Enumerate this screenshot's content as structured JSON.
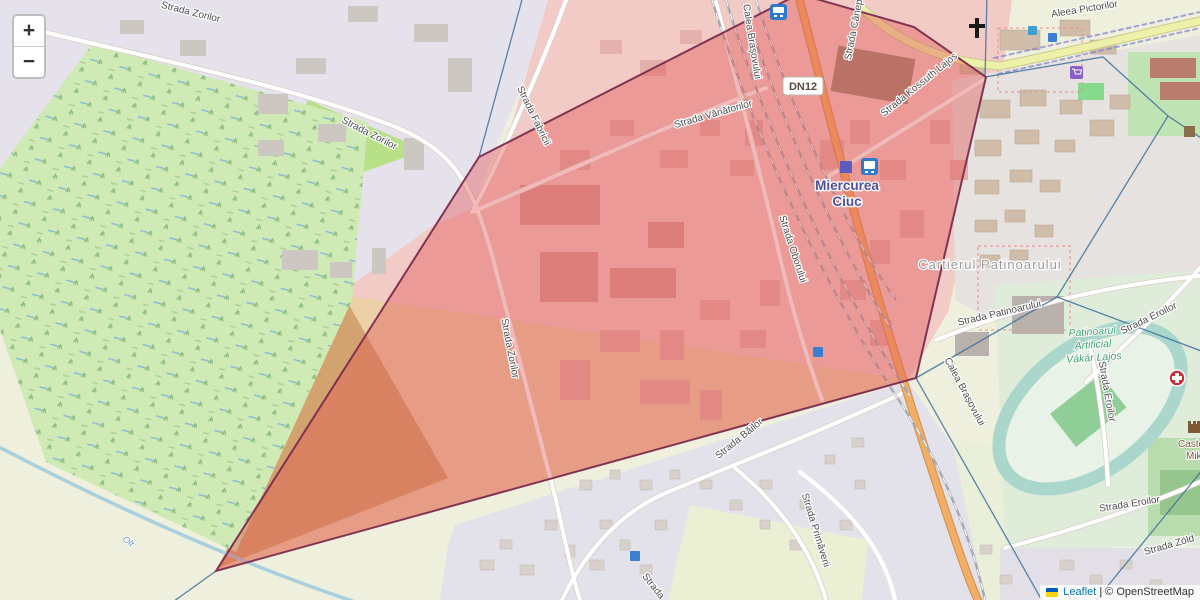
{
  "controls": {
    "zoom_in": "+",
    "zoom_out": "−"
  },
  "attribution": {
    "leaflet_link": "Leaflet",
    "separator": "|",
    "osm_credit": "© OpenStreetMap"
  },
  "badges": {
    "road_ref": "DN12"
  },
  "labels": {
    "city_line1": "Miercurea",
    "city_line2": "Ciuc",
    "neighborhood": "Cartierul Patinoarului",
    "stadium_line1": "Patinoarul",
    "stadium_line2": "Artificial",
    "stadium_line3": "Vákár Lajos",
    "castle_line1": "Castelul",
    "castle_line2": "Mikó",
    "river": "Olt",
    "streets": [
      {
        "text": "Strada Zorilor",
        "x": 190,
        "y": 15,
        "r": 14
      },
      {
        "text": "Strada Zorilor",
        "x": 368,
        "y": 136,
        "r": 27
      },
      {
        "text": "Strada Fabricii",
        "x": 531,
        "y": 117,
        "r": 64
      },
      {
        "text": "Strada Zorilor",
        "x": 507,
        "y": 349,
        "r": 79
      },
      {
        "text": "Strada Vânătorilor",
        "x": 714,
        "y": 117,
        "r": -16
      },
      {
        "text": "Strada Oborului",
        "x": 790,
        "y": 250,
        "r": 72
      },
      {
        "text": "Strada Cânepii",
        "x": 857,
        "y": 28,
        "r": -79
      },
      {
        "text": "Strada Kossuth Lajos",
        "x": 921,
        "y": 87,
        "r": -39
      },
      {
        "text": "Strada Patinoarului",
        "x": 1000,
        "y": 316,
        "r": -13
      },
      {
        "text": "Strada Eroilor",
        "x": 1150,
        "y": 321,
        "r": -26
      },
      {
        "text": "Strada Eroilor",
        "x": 1104,
        "y": 392,
        "r": 80
      },
      {
        "text": "Strada Eroilor",
        "x": 1130,
        "y": 507,
        "r": -9
      },
      {
        "text": "Strada Zöld",
        "x": 1170,
        "y": 548,
        "r": -16
      },
      {
        "text": "Calea Brașovului",
        "x": 962,
        "y": 393,
        "r": 62
      },
      {
        "text": "Calea Brașovului",
        "x": 749,
        "y": 42,
        "r": 81
      },
      {
        "text": "Strada Băilor",
        "x": 741,
        "y": 441,
        "r": -39
      },
      {
        "text": "Strada Primăverii",
        "x": 813,
        "y": 531,
        "r": 73
      },
      {
        "text": "Strada",
        "x": 651,
        "y": 588,
        "r": 52
      },
      {
        "text": "Aleea Pictorilor",
        "x": 1085,
        "y": 12,
        "r": -9
      }
    ]
  },
  "icons": [
    "bus-stop",
    "railway-station",
    "train-station",
    "church-cross",
    "supermarket-cart",
    "hospital-cross",
    "castle",
    "bank",
    "poi-marker"
  ],
  "colors": {
    "overlay_fill": "#e14f4f",
    "overlay_stroke": "#7c2b4e",
    "boundary_line": "#3e6f9e",
    "primary_road": "#f3ae66",
    "tertiary_road": "#edf0a8",
    "link_blue": "#0078a8"
  }
}
